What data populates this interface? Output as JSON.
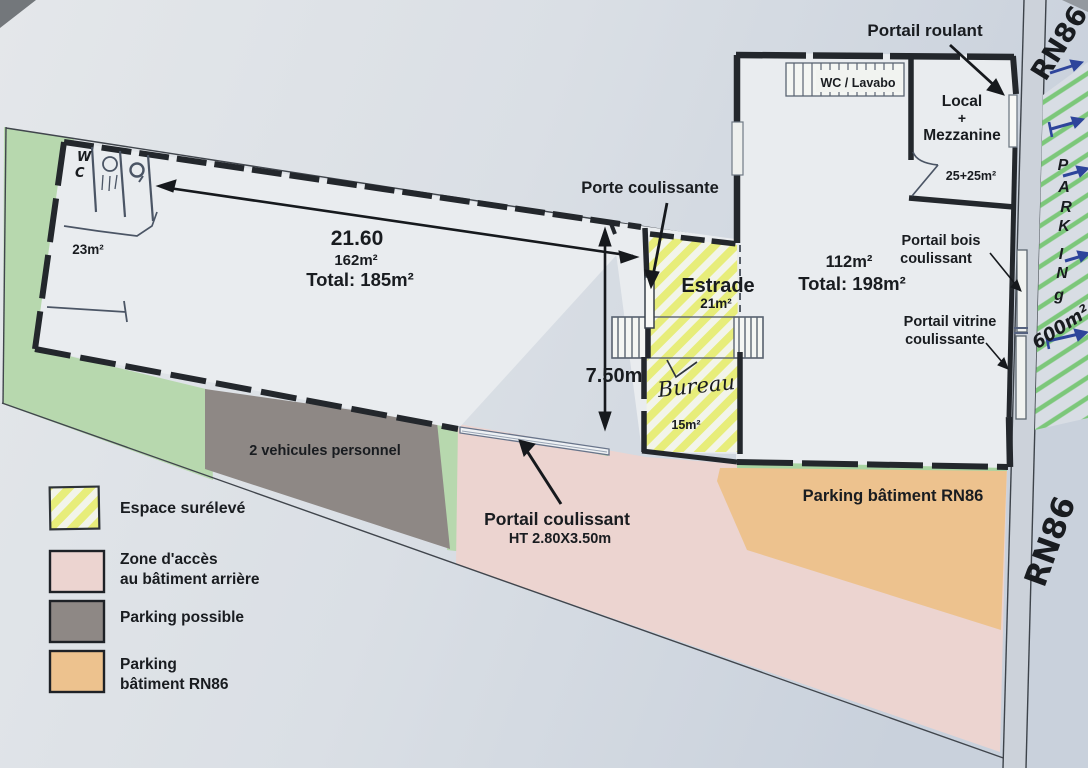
{
  "labels": {
    "dim_2160": "21.60",
    "area_162": "162m²",
    "total_185": "Total: 185m²",
    "area_23": "23m²",
    "porte_coulissante": "Porte coulissante",
    "estrade": "Estrade",
    "area_21": "21m²",
    "dim_750": "7.50m",
    "area_15": "15m²",
    "wc_lavabo": "WC / Lavabo",
    "local": "Local",
    "plus": "+",
    "mezzanine": "Mezzanine",
    "area_2525": "25+25m²",
    "area_112": "112m²",
    "total_198": "Total: 198m²",
    "portail_roulant": "Portail roulant",
    "portail_bois_l1": "Portail bois",
    "portail_bois_l2": "coulissant",
    "portail_vitrine_l1": "Portail vitrine",
    "portail_vitrine_l2": "coulissante",
    "vehicules": "2 vehicules personnel",
    "portail_coulissant": "Portail coulissant",
    "portail_ht": "HT 2.80X3.50m",
    "parking_rn86": "Parking bâtiment RN86"
  },
  "legend": {
    "items": [
      {
        "label": "Espace surélevé"
      },
      {
        "line1": "Zone d'accès",
        "line2": "au bâtiment arrière"
      },
      {
        "label": "Parking possible"
      },
      {
        "line1": "Parking",
        "line2": "bâtiment RN86"
      }
    ]
  },
  "handwritten": {
    "rn86_top": "RN86",
    "rn86_bottom": "RN86",
    "parking_letters": [
      "P",
      "A",
      "R",
      "K",
      "I",
      "N",
      "g"
    ],
    "area_600": "600m²",
    "wc_w": "W",
    "wc_c": "C",
    "bureau": "Bureau"
  },
  "colors": {
    "paper": "#dbe0e6",
    "wall": "#23272c",
    "ink": "#191c20",
    "green_zone": "#b7d8ae",
    "gray_zone": "#8e8885",
    "pink_zone": "#ecd4d0",
    "orange_zone": "#edc28e",
    "yellow_stripe": "#e6ed6e",
    "green_hatch": "#7cc77a",
    "blue_pen": "#2e459b",
    "pen_gray": "#4b5565"
  }
}
